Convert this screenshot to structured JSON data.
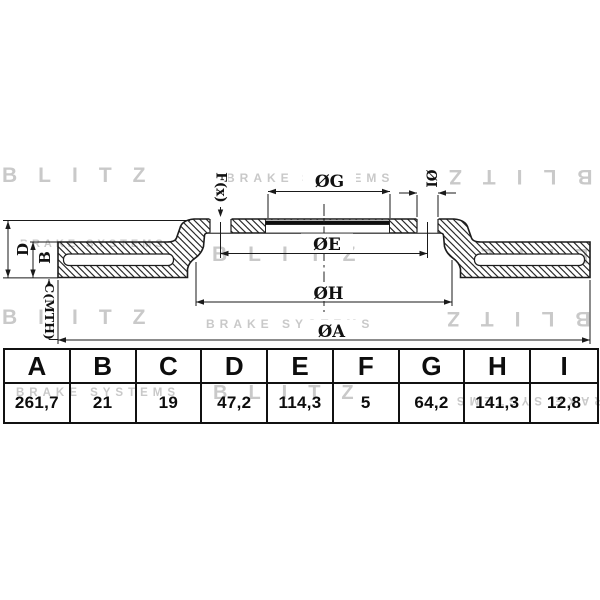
{
  "brand": {
    "name": "BLITZ",
    "tagline": "BRAKE SYSTEMS"
  },
  "drawing": {
    "description": "Vented brake disc cross-section with dimension callouts",
    "dim_labels": {
      "A": "ØA",
      "B": "B",
      "C": "C(MTH)",
      "D": "D",
      "E": "ØE",
      "F": "F(x)",
      "G": "ØG",
      "H": "ØH",
      "I": "ØI"
    }
  },
  "table": {
    "columns": [
      {
        "label": "A",
        "value": "261,7"
      },
      {
        "label": "B",
        "value": "21"
      },
      {
        "label": "C",
        "value": "19"
      },
      {
        "label": "D",
        "value": "47,2"
      },
      {
        "label": "E",
        "value": "114,3"
      },
      {
        "label": "F",
        "value": "5"
      },
      {
        "label": "G",
        "value": "64,2"
      },
      {
        "label": "H",
        "value": "141,3"
      },
      {
        "label": "I",
        "value": "12,8"
      }
    ]
  },
  "colors": {
    "line": "#1c1c1c",
    "watermark": "#c9c9c9",
    "background": "#ffffff",
    "bore_band": "#0f0f0f"
  }
}
